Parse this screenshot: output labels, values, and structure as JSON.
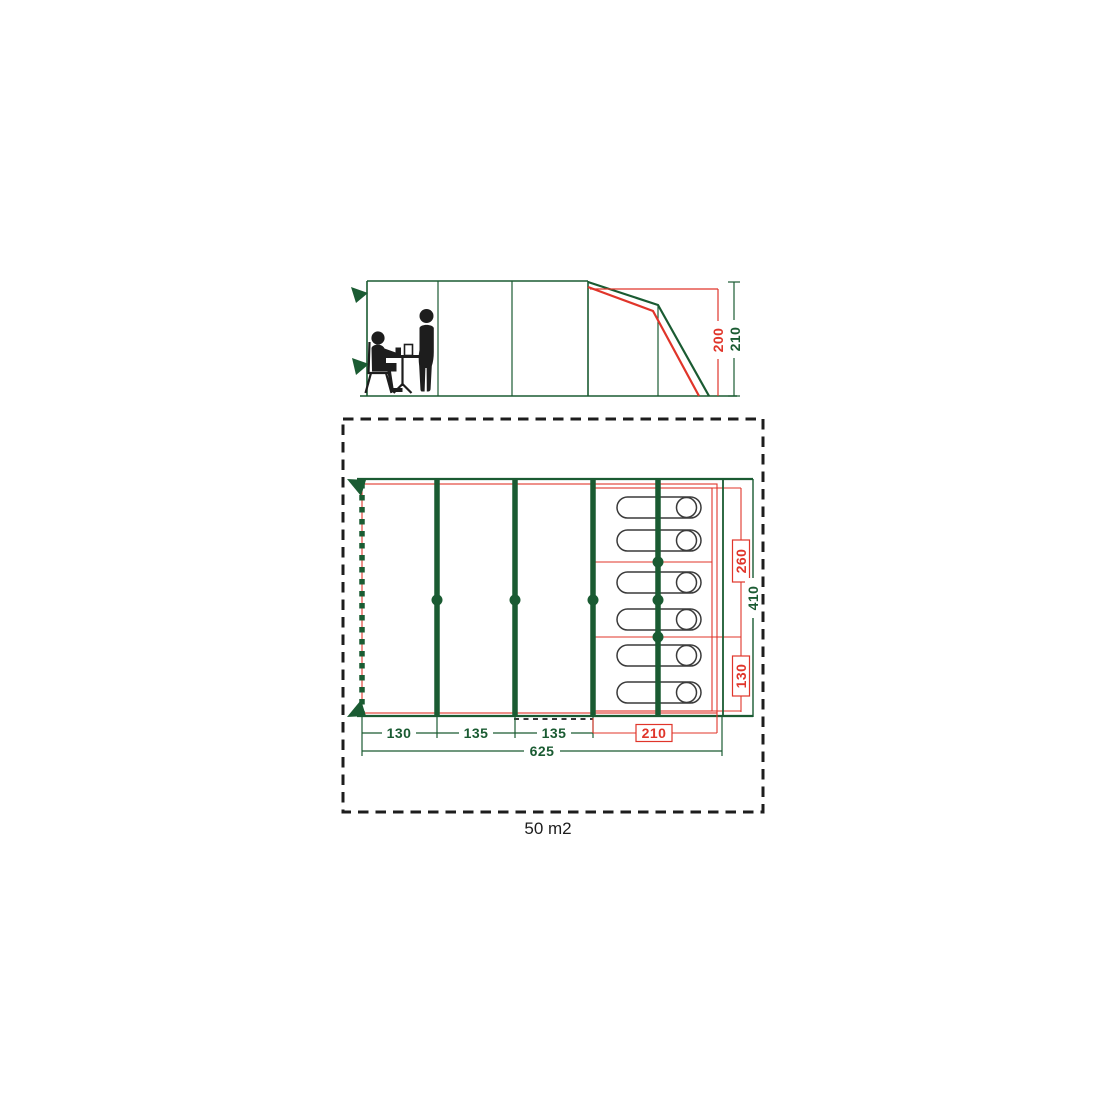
{
  "diagram": {
    "type": "tent-dimension-diagram",
    "colors": {
      "green": "#1a5b32",
      "red": "#e0352a",
      "black": "#1d1d1d"
    },
    "elevation": {
      "inner_height": "200",
      "peak_height": "210"
    },
    "floor_plan": {
      "bottom_segments": [
        "130",
        "135",
        "135"
      ],
      "cabin_width": "210",
      "total_width": "625",
      "cabin_depth_upper": "260",
      "cabin_depth_lower": "130",
      "total_depth": "410",
      "area": "50 m2",
      "sleeping_bag_count": 6
    }
  }
}
